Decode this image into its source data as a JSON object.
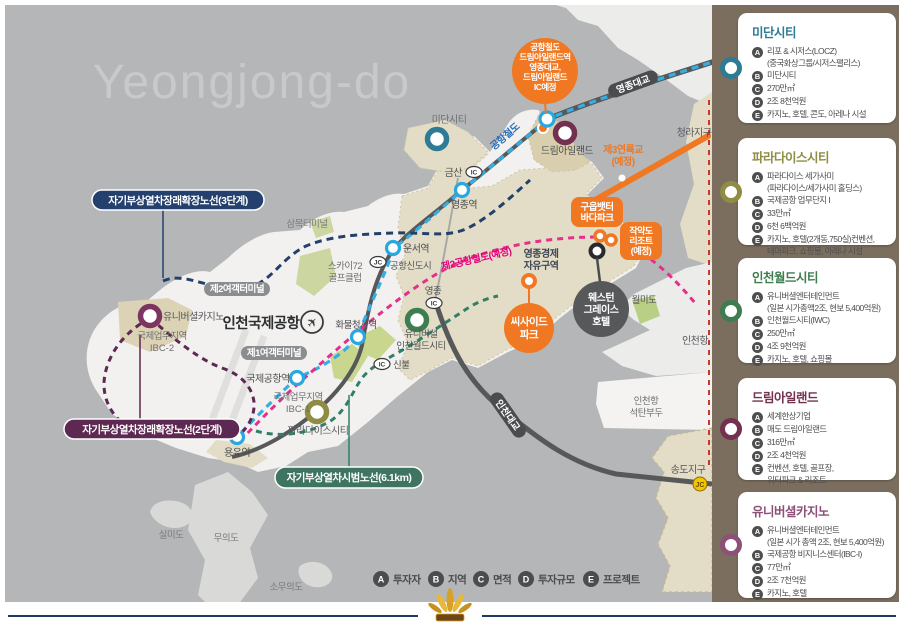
{
  "title": "Yeongjong-do",
  "map": {
    "badges": {
      "maglev3": "자기부상열차장래확장노선(3단계)",
      "maglev2": "자기부상열차장래확장노선(2단계)",
      "maglev_test": "자기부상열차시범노선(6.1km)",
      "airport_rail_circle": [
        "공항철도",
        "드림아일랜드역",
        "영종대교,",
        "드림아일랜드",
        "IC예정"
      ],
      "guueup": [
        "구읍뱃터",
        "바다파크"
      ],
      "jakyakdo": [
        "작약도",
        "리조트",
        "(예정)"
      ],
      "seaside": [
        "씨사이드",
        "파크"
      ],
      "western_grace": [
        "웨스턴",
        "그레이스",
        "호텔"
      ],
      "terminal1": "제1여객터미널",
      "terminal2": "제2여객터미널",
      "yeongjong_bridge": "영종대교",
      "incheon_bridge": "인천대교"
    },
    "labels": {
      "midan": "미단시티",
      "geumsan": "금산",
      "yeongjong_stn": "영종역",
      "sammok": "삼목터미널",
      "sky72a": "스카이72",
      "sky72b": "골프클럽",
      "unseo": "운서역",
      "airport_newtown": "공항신도시",
      "rail2_planned": "제2공항철도(예정)",
      "airport_rail_text": "공항철도",
      "yeongjong_ic": "영종",
      "cargo": "화물청사역",
      "iia": "인천국제공항",
      "ucasino": "유니버셜카지노",
      "ibc2a": "국제업무지역",
      "ibc2b": "IBC-2",
      "iwca": "유니버셜",
      "iwcb": "인천월드시티",
      "airport_stn": "국제공항역",
      "ibc1a": "국제업무지역",
      "ibc1b": "IBC-1",
      "paradise": "파라다이스시티",
      "sinbul": "신불",
      "yongyu": "용유역",
      "dream": "드림아일랜드",
      "cheongna": "청라지구",
      "bridge3a": "제3연륙교",
      "bridge3b": "(예정)",
      "econ_a": "영종경제",
      "econ_b": "자유구역",
      "wolmido": "월미도",
      "incheon_port": "인천항",
      "coal_a": "인천항",
      "coal_b": "석탄부두",
      "songdo": "송도지구",
      "jc": "JC",
      "ic": "IC",
      "silmido": "실미도",
      "muuido": "무의도",
      "somuuido": "소무의도"
    },
    "legend": [
      {
        "k": "A",
        "t": "투자자"
      },
      {
        "k": "B",
        "t": "지역"
      },
      {
        "k": "C",
        "t": "면적"
      },
      {
        "k": "D",
        "t": "투자규모"
      },
      {
        "k": "E",
        "t": "프로젝트"
      }
    ],
    "colors": {
      "sea": "#b4b6b8",
      "land": "#f2f1ef",
      "zone_beige": "#e3ddc7",
      "orange_accent": "#f07822",
      "rail_blue": "#35aee4",
      "rail2_magenta": "#e5007e",
      "maglev3_navy": "#23406b",
      "maglev2_purple": "#5d2851",
      "maglev_test_green": "#2f8069"
    }
  },
  "sidebar": {
    "cards": [
      {
        "title": "미단시티",
        "color": "#2e7b95",
        "items": [
          {
            "k": "A",
            "lines": [
              "리포 & 시저스(LOCZ)",
              "(중국화상그룹/시저스팰리스)"
            ]
          },
          {
            "k": "B",
            "lines": [
              "미단시티"
            ]
          },
          {
            "k": "C",
            "lines": [
              "270만㎡"
            ]
          },
          {
            "k": "D",
            "lines": [
              "2조 8천억원"
            ]
          },
          {
            "k": "E",
            "lines": [
              "카지노, 호텔, 콘도, 아레나 시설"
            ]
          }
        ]
      },
      {
        "title": "파라다이스시티",
        "color": "#8f8c44",
        "items": [
          {
            "k": "A",
            "lines": [
              "파라다이스 세가사미",
              "(파라다이스/세가사미 홀딩스)"
            ]
          },
          {
            "k": "B",
            "lines": [
              "국제공항 업무단지 I"
            ]
          },
          {
            "k": "C",
            "lines": [
              "33만㎡"
            ]
          },
          {
            "k": "D",
            "lines": [
              "6천 6백억원"
            ]
          },
          {
            "k": "E",
            "lines": [
              "카지노, 호텔(2개동,750실)컨벤션,",
              "테마파크, 쇼핑몰, 아레나 시설",
              "(2만명 수용)"
            ]
          }
        ]
      },
      {
        "title": "인천월드시티",
        "color": "#3e7d4f",
        "items": [
          {
            "k": "A",
            "lines": [
              "유니버셜엔터테인먼트",
              "(일본 시가총액2조, 현보 5,400억원)"
            ]
          },
          {
            "k": "B",
            "lines": [
              "인천월드시티(IWC)"
            ]
          },
          {
            "k": "C",
            "lines": [
              "250만㎡"
            ]
          },
          {
            "k": "D",
            "lines": [
              "4조 9천억원"
            ]
          },
          {
            "k": "E",
            "lines": [
              "카지노, 호텔, 쇼핑몰"
            ]
          }
        ]
      },
      {
        "title": "드림아일랜드",
        "color": "#73304f",
        "items": [
          {
            "k": "A",
            "lines": [
              "세계한상기업"
            ]
          },
          {
            "k": "B",
            "lines": [
              "매도 드림아일랜드"
            ]
          },
          {
            "k": "C",
            "lines": [
              "316만㎡"
            ]
          },
          {
            "k": "D",
            "lines": [
              "2조 4천억원"
            ]
          },
          {
            "k": "E",
            "lines": [
              "컨벤션, 호텔, 골프장,",
              "워터파크 & 리조트"
            ]
          }
        ]
      },
      {
        "title": "유니버셜카지노",
        "color": "#8d5076",
        "items": [
          {
            "k": "A",
            "lines": [
              "유니버셜엔터테인먼트",
              "(일본 시가 총액 2조, 현보 5,400억원)"
            ]
          },
          {
            "k": "B",
            "lines": [
              "국제공항 비지니스센터(IBC-I)"
            ]
          },
          {
            "k": "C",
            "lines": [
              "77만㎡"
            ]
          },
          {
            "k": "D",
            "lines": [
              "2조 7천억원"
            ]
          },
          {
            "k": "E",
            "lines": [
              "카지노, 호텔"
            ]
          }
        ]
      }
    ]
  }
}
